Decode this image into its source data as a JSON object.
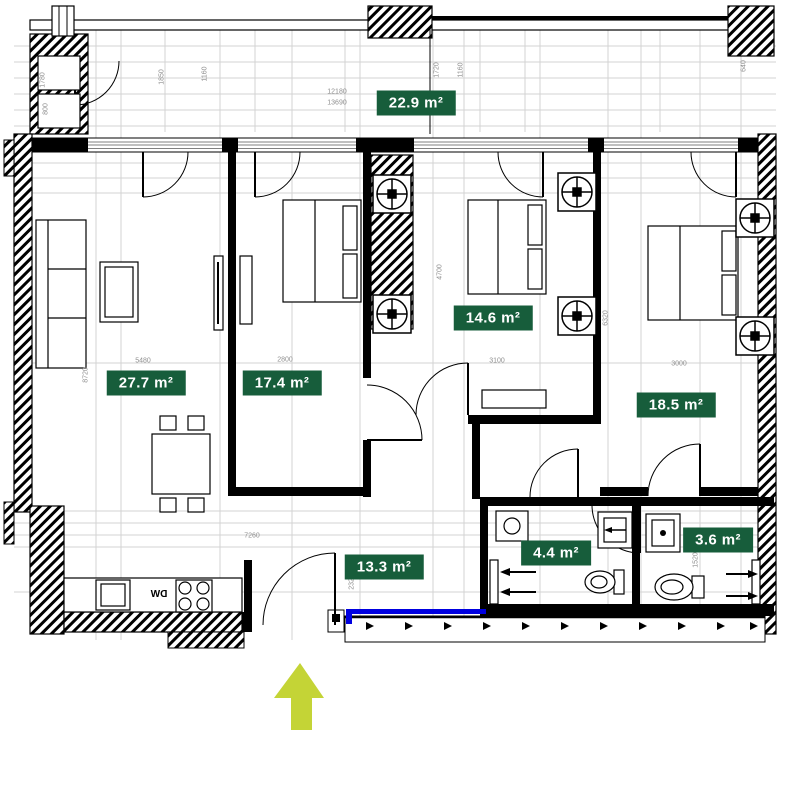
{
  "plan": {
    "type": "apartment-floor-plan",
    "entrance_marker": "up-arrow"
  },
  "colors": {
    "badge_bg": "#175d3b",
    "badge_text": "#ffffff",
    "entrance_arrow": "#c4d436",
    "terrace_line": "#0000e0",
    "dim_text": "#8f8f8f",
    "wall": "#000000"
  },
  "rooms": [
    {
      "id": "balcony",
      "area_label": "22.9 m²"
    },
    {
      "id": "living-room",
      "area_label": "27.7 m²"
    },
    {
      "id": "bedroom-1",
      "area_label": "17.4 m²"
    },
    {
      "id": "bedroom-2",
      "area_label": "14.6 m²"
    },
    {
      "id": "bedroom-3",
      "area_label": "18.5 m²"
    },
    {
      "id": "hallway",
      "area_label": "13.3 m²"
    },
    {
      "id": "bathroom",
      "area_label": "4.4 m²"
    },
    {
      "id": "wc",
      "area_label": "3.6 m²"
    }
  ],
  "kitchen": {
    "dishwasher_label": "DW"
  },
  "dims": [
    {
      "text": "12180"
    },
    {
      "text": "13690"
    },
    {
      "text": "5480"
    },
    {
      "text": "2800"
    },
    {
      "text": "3100"
    },
    {
      "text": "3000"
    },
    {
      "text": "4700"
    },
    {
      "text": "6320"
    },
    {
      "text": "8720"
    },
    {
      "text": "1780"
    },
    {
      "text": "800"
    },
    {
      "text": "1850"
    },
    {
      "text": "1160"
    },
    {
      "text": "1720"
    },
    {
      "text": "1160"
    },
    {
      "text": "640"
    },
    {
      "text": "2320"
    },
    {
      "text": "7260"
    },
    {
      "text": "1520"
    }
  ]
}
